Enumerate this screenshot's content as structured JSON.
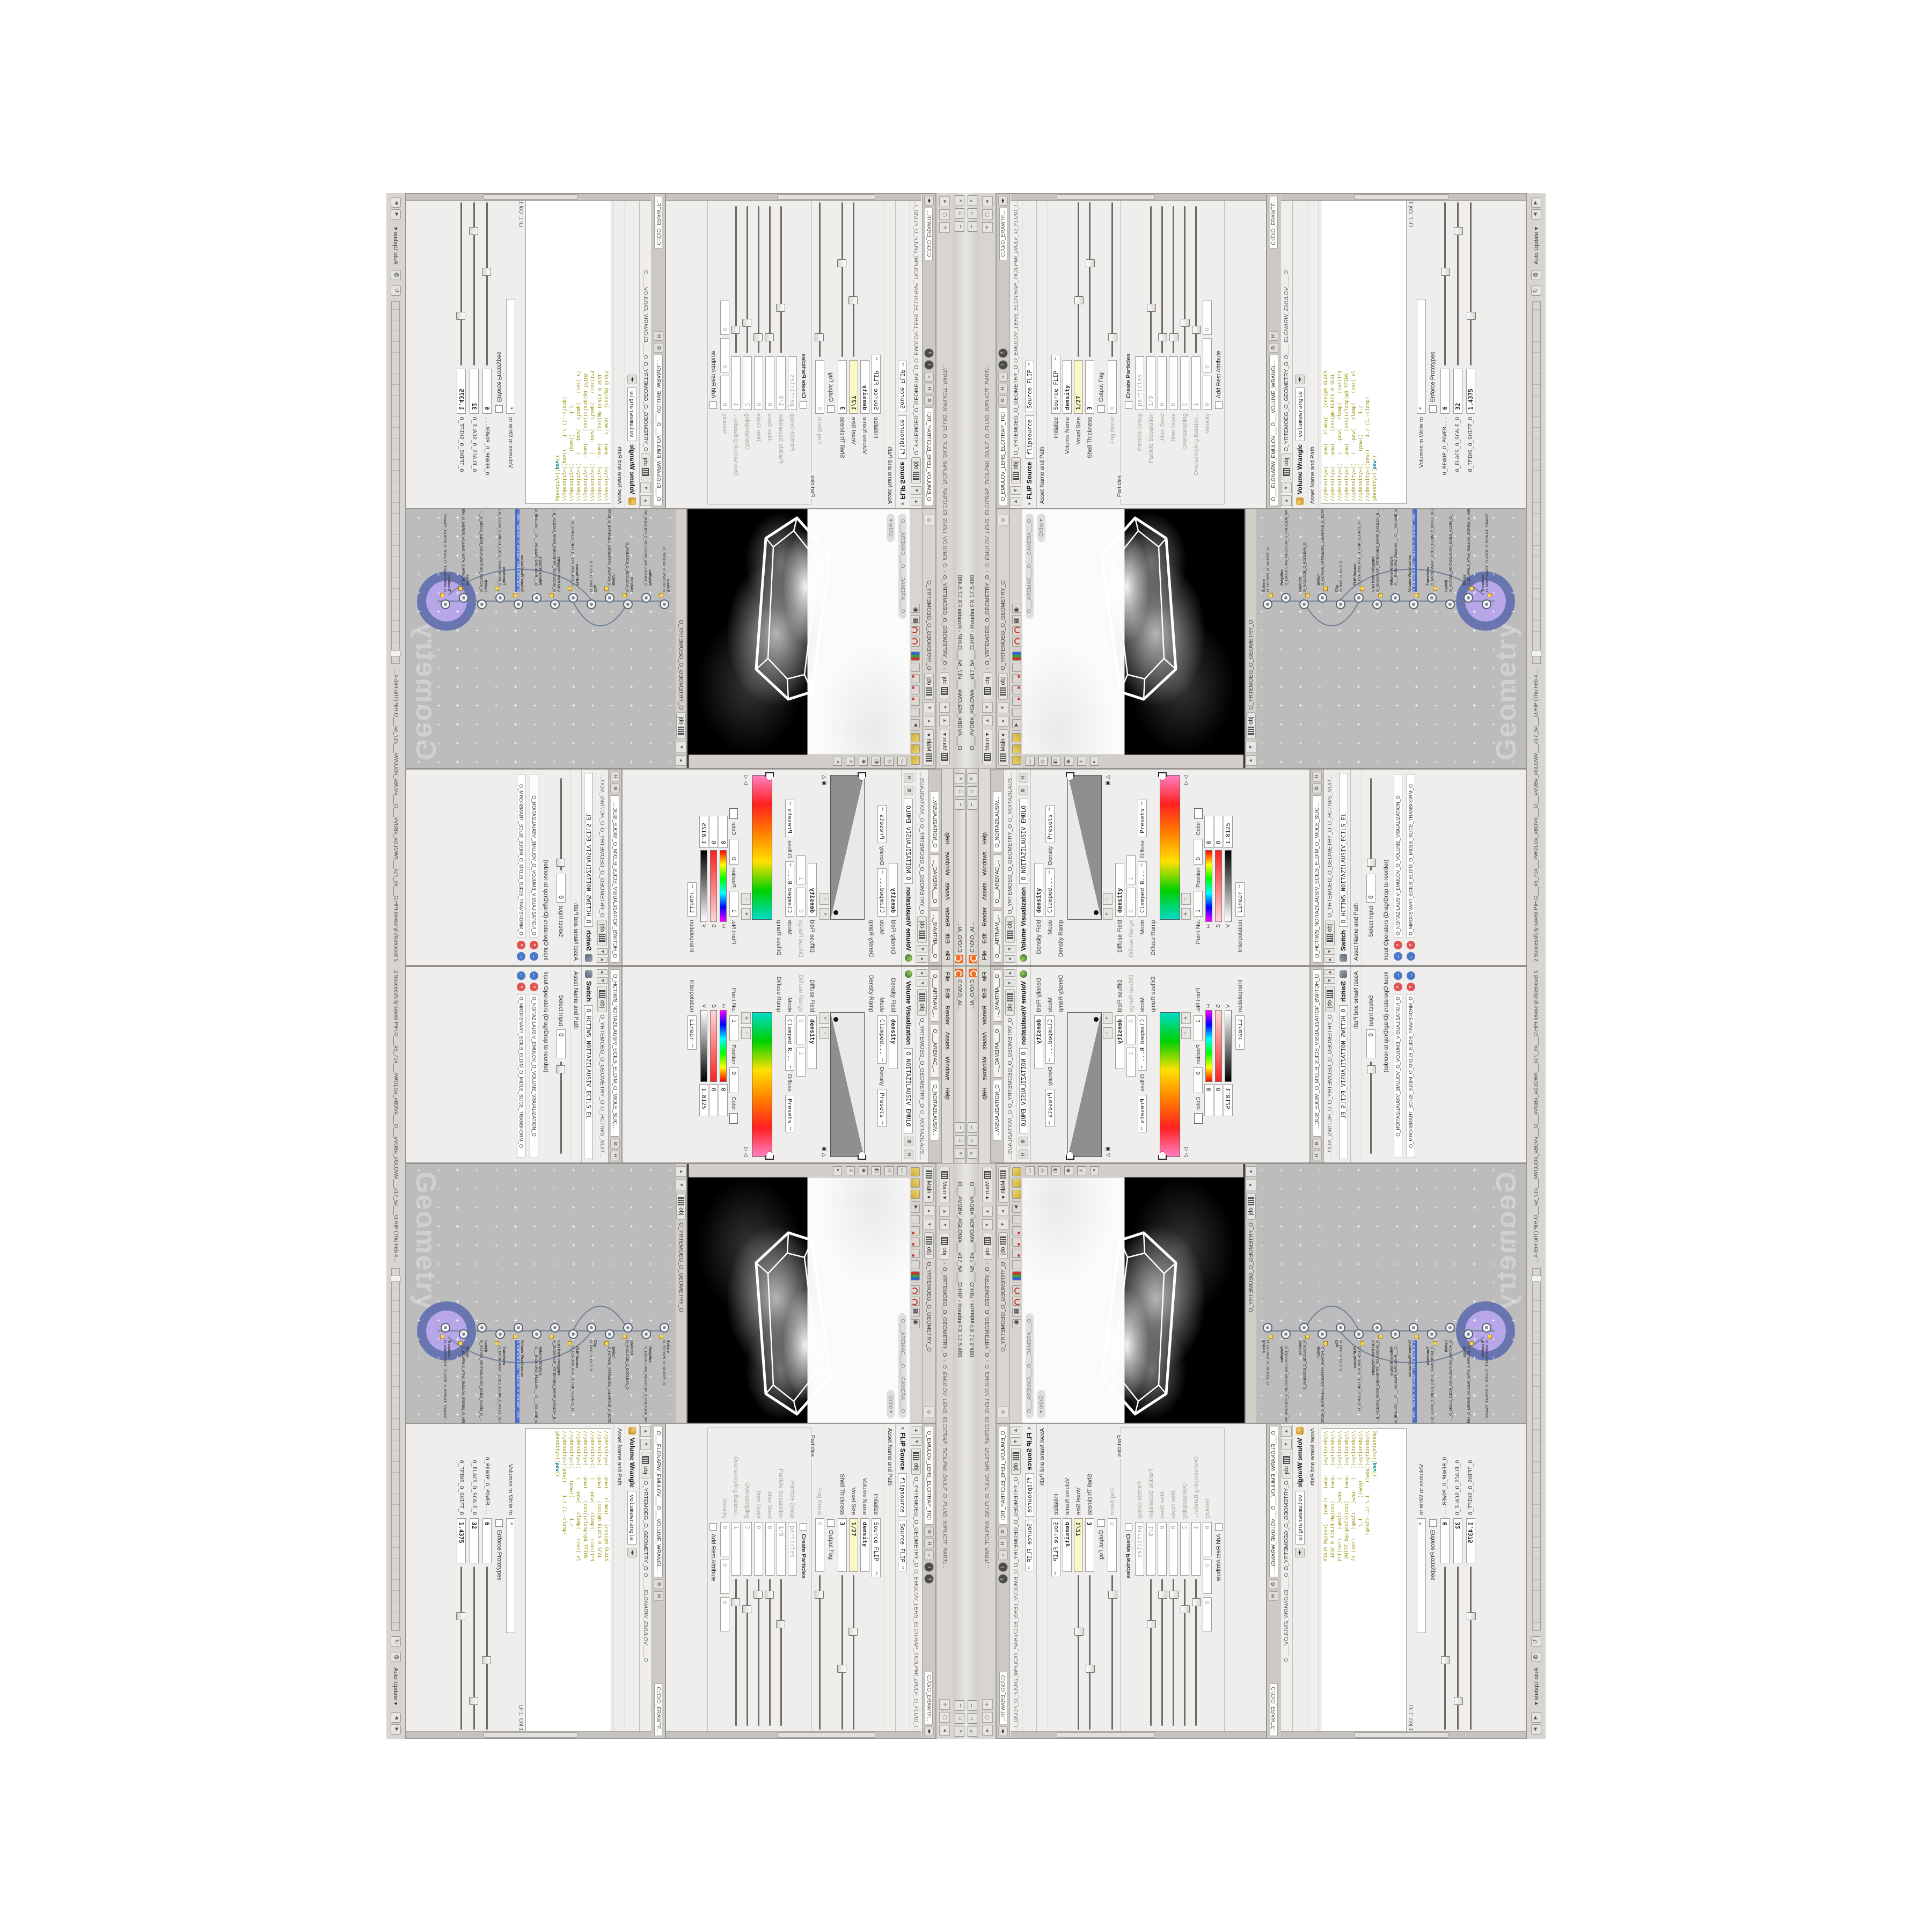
{
  "app": {
    "title": "O___#VDB#_#GLOW#___#17_5#___O.HIP - Houdini FX 17.5.480",
    "status_message": "2 Successfully saved PIH.O___#5_71#___#WOLG#_#BDV#___O___#VDB#_#GLOW#___#17_5#___O.HIP (Thu Feb 4 10:46:01 2021)",
    "auto_update_label": "Auto Update"
  },
  "main_path": {
    "pane_menu": "Main",
    "crumb_root": "obj",
    "crumb_geo": "O_YRTEMOEG_O_GEOMETRY_O",
    "crumb_node": "O_EMULOV_LEHS_ELCITRAP_TICILPMI_DIULF_O_FLUID_IMPLICIT_PARTI...",
    "path_field": "C:/O/O_ERAWTF..."
  },
  "viewport": {
    "pane_menu": "Main",
    "crumb_root": "obj",
    "crumb_geo": "O_YRTEMOEG_O_GEOMETRY_O",
    "camera_pill": "O___AREMAC___O___CAMERA___O",
    "view_pill": "Ortho"
  },
  "flip": {
    "tab": "O_EMULOV_LEHS_ELCITRAP_TICI",
    "path_field": "C:/O/O_ERAWTF...",
    "crumb_root": "obj",
    "crumb_geo": "O_YRTEMOEG_O_GEOMETRY_O",
    "crumb_node": "O_EMULOV_LEHS_ELCITRAP_TICILPMI_DIULF_O_FLUID_IMPLICIT_PARTI...",
    "title": "FLIP Source",
    "name_field": "flipsource",
    "preset": "Source FLIP",
    "asset_label": "Asset Name and Path",
    "rows": {
      "initialize": {
        "label": "Initialize",
        "value": "Source FLIP"
      },
      "volume_name": {
        "label": "Volume Name",
        "value": "density"
      },
      "voxel_size": {
        "label": "Voxel Size",
        "value": "1/27"
      },
      "shell_thickness": {
        "label": "Shell Thickness",
        "value": "3"
      },
      "output_fog": {
        "label": "Output Fog"
      },
      "fog_boost": {
        "label": "Fog Boost",
        "value": "0"
      },
      "particles_group": "Particles",
      "create_particles": {
        "label": "Create Particles"
      },
      "particle_group": {
        "label": "Particle Group",
        "value": "particles"
      },
      "particle_separation": {
        "label": "Particle Separation",
        "value": "1/9"
      },
      "jitter_seed": {
        "label": "Jitter Seed",
        "value": "0"
      },
      "jitter_scale": {
        "label": "Jitter Scale",
        "value": "0"
      },
      "oversampling": {
        "label": "Oversampling",
        "value": "2"
      },
      "oversampling_bw": {
        "label": "Oversampling Bandwi...",
        "value": "1"
      },
      "velocity": {
        "label": "Velocity",
        "v1": "0",
        "v2": "0",
        "v3": "0"
      },
      "add_rest": {
        "label": "Add Rest Attribute"
      }
    }
  },
  "wrangle": {
    "tab": "O___ELGNARW_EMULOV___O___VOLUME_WRANGL...",
    "crumb_root": "obj",
    "crumb_geo": "O_YRTEMOEG_O_GEOMETRY_O",
    "crumb_node": "O____ELGNARW_EMULOV____O",
    "title": "Volume Wrangle",
    "name_field": "volumewrangle",
    "asset_label": "Asset Name and Path",
    "code": {
      "l0": "//@density=(   -pow(   clamp(   (cos(@O_ELACS_",
      "l1": "//@density=(   -pow(    (cos(@O_ELACS_O_SCAL",
      "l2": "//@density=((   (   -pow(   clamp(   (cos(1*$",
      "l3": "//@density=(   -pow(    (cos((clamp(@O_TFIHS",
      "l4": "//@density=((   (   -pow(   clamp(   (cos( cl",
      "l5": "//@density=((    (pow((       1./",
      "l6": "//@density=((pow((    1./ (1.-clamp(",
      "active_pre": "@density=((",
      "active_kw": "pow",
      "active_suf": "(("
    },
    "cursor_pos": "Ln 1, Col 1",
    "volumes_label": "Volumes to Write to",
    "volumes_value": "*",
    "enforce_label": "Enforce Prototypes",
    "sliders": {
      "power": {
        "label": "O_REWOP_O_POWER...",
        "value": "6"
      },
      "scale": {
        "label": "O_ELACS_O_SCALE_O",
        "value": "32"
      },
      "shift": {
        "label": "O_TFIHS_O_SHIFT_O",
        "value": "1.4375"
      }
    }
  },
  "volvis": {
    "float_title": "C:\\O\\O_AI...",
    "menu": {
      "file": "File",
      "edit": "Edit",
      "render": "Render",
      "assets": "Assets",
      "windows": "Windows",
      "help": "Help"
    },
    "tabs": {
      "t0": "O___ARTNAM_...",
      "t1": "O___AREMAC_...",
      "t2": "O_NOITAZILAUSIV..."
    },
    "crumb_root": "obj",
    "crumb_geo": "O_YRTEMOEG_O_GEOMETRY_O",
    "crumb_node": "O_NOITAZILAUSIV_EMULO",
    "title": "Volume Visualization",
    "density_field_label": "Density Field",
    "density_field_value": "density",
    "mode_label": "Mode",
    "density_mode_value": "Clamped...",
    "density_ramp_header": "Density",
    "presets_label": "Presets",
    "density_ramp_label": "Density Ramp",
    "diffuse_field_label": "Diffuse Field",
    "diffuse_field_value": "density",
    "diffuse_range_label": "Diffuse Range",
    "range_min": "0",
    "range_max": "1",
    "diffuse_mode_value": "Clamped R...",
    "diffuse_ramp_header": "Diffuse",
    "diffuse_ramp_label": "Diffuse Ramp",
    "point_label": "Point No.",
    "point_value": "1",
    "position_label": "Position",
    "position_value": "0",
    "color_label": "Color",
    "h_label": "H",
    "h_value": "0",
    "s_label": "S",
    "s_value": "0",
    "v_label": "V",
    "v_value": "1.8125",
    "interp_label": "Interpolation",
    "interp_value": "Linear"
  },
  "switch_pane": {
    "tab": "O_HCTIWS_NOITAZILAUSIV_ECILS_ELDIM_O_MIDLE_SLICE_VISUAL...",
    "crumb_root": "obj",
    "crumb_geo": "O_YRTEMOEG_O_GEOMETRY_O",
    "crumb_node": "O_HCTIWS_NOITAZILAUSIV_ECILS_EL",
    "title": "Switch",
    "name_field": "O_HCTIWS_NOITAZILAUSIV_ECILS_EL",
    "asset_label": "Asset Name and Path",
    "select_label": "Select Input",
    "select_value": "0",
    "inputs_label": "Input Operators (Drag/Drop to reorder)",
    "input_0": "O_NOITAZILAUSIV_EMULOV_O_VOLUME_VISUALIZATION_O",
    "input_1": "O_MROFSNART_ECILS_ELDIM_O_MIDLE_SLICE_TRANSFORM_O"
  },
  "network": {
    "watermark": "Geometry",
    "nodes": [
      {
        "type": "Sphere",
        "name": "O_EREHPS_O_SPHERE_O"
      },
      {
        "type": "PolyWire",
        "name": "O_EMARFERIW_NOGYLOP_O_POLYGON_WIREFRAME_O"
      },
      {
        "type": "Boolean",
        "name": "O_NAELOOB_O_BOOLEAN_O"
      },
      {
        "type": "Switch",
        "name": "O_HCTIWS_YRTEMOEG_LANRETXE_O_EXTERNAL_GEOMETRY_SWITCH_O"
      },
      {
        "type": "Clip",
        "name": "O_PILC_O_CLIP_O"
      },
      {
        "type": "FLIP Source",
        "name": "O_ECRUOS_PILF_O_FLIP_SOURCE_O"
      },
      {
        "type": "VDB from Polygons",
        "name": "O_SNOGYLOP_YRTEMOEG_MORF_EMULOV_BDV_O_VDB_VOLUME_FROM_GEOMETRY_POLYGONS_O"
      },
      {
        "type": "Volume Wrangle",
        "name": "O___ELGNARW_EMULOV___O___VOLUME_WRANGLE___O"
      },
      {
        "type": "Volume Visualization",
        "name": "O_NOITAZILAUSIV_EMULOV_O_VOLUME_VISUALIZATION_O",
        "selected": true
      },
      {
        "type": "Transform",
        "name": "O_MROFSNART_ECILS_ELDIM_O_MIDLE_SLICE_TRANSFORM_O"
      },
      {
        "type": "Switch",
        "name": "O_HCTIWS_NOITAZILAUSIV_ECILS_ELDIM_O_MIDLE_SLICE_VISUALIZATION_SWITCH_O"
      },
      {
        "type": "Merge",
        "name": "O_ECAFRUS_HTIW_EMULOV_EGREM_O_MERGE_VOLUME_WITH_SURFACE_O"
      },
      {
        "type": "Transform",
        "name": "O_MROFSNART_TLUSER_O_RESULT_TRANSFORM_O",
        "badge": true
      }
    ]
  },
  "colors": {
    "accent_orange": "#f26d21",
    "badge_outer": "#5c6ca6",
    "badge_inner": "#b7a7e9",
    "code_olive": "#909000",
    "highlight_field": "#fbf8c8",
    "network_bg": "#bcbcbc"
  }
}
